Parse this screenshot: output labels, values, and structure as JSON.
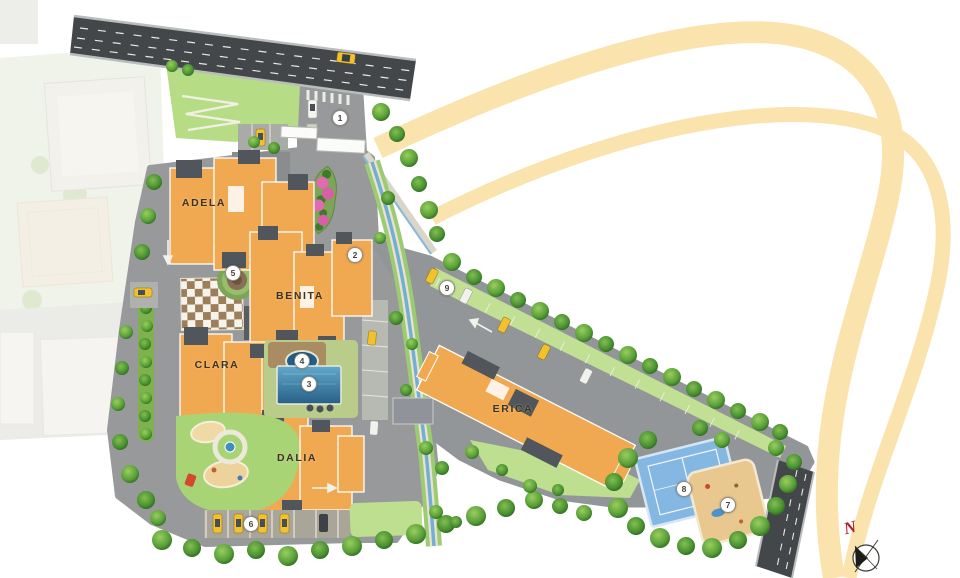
{
  "plan": {
    "type": "residential-site-plan",
    "buildings": [
      {
        "id": "adela",
        "label": "ADELA",
        "x": 204,
        "y": 203
      },
      {
        "id": "benita",
        "label": "BENITA",
        "x": 300,
        "y": 296
      },
      {
        "id": "clara",
        "label": "CLARA",
        "x": 217,
        "y": 365
      },
      {
        "id": "dalia",
        "label": "DALIA",
        "x": 297,
        "y": 458
      },
      {
        "id": "erica",
        "label": "ERICA",
        "x": 513,
        "y": 409
      }
    ],
    "markers": [
      {
        "number": "1",
        "x": 340,
        "y": 118
      },
      {
        "number": "2",
        "x": 355,
        "y": 255
      },
      {
        "number": "3",
        "x": 309,
        "y": 384
      },
      {
        "number": "4",
        "x": 302,
        "y": 361
      },
      {
        "number": "5",
        "x": 233,
        "y": 273
      },
      {
        "number": "6",
        "x": 251,
        "y": 524
      },
      {
        "number": "7",
        "x": 728,
        "y": 505
      },
      {
        "number": "8",
        "x": 684,
        "y": 489
      },
      {
        "number": "9",
        "x": 447,
        "y": 288
      }
    ],
    "compass": {
      "north_label": "N"
    },
    "palette": {
      "building_orange": "#F1A951",
      "roof_slate": "#50565C",
      "arc_wheat": "#FAE3AC",
      "pool_blue": "#2F7EA8",
      "tennis_blue": "#85B7E3",
      "sand_tan": "#E9C88F",
      "road_dark": "#43474A",
      "pavement_gray": "#97999B",
      "lawn_green": "#A9D476",
      "tree_green": "#3E7A26",
      "taxi_yellow": "#F2C12E",
      "flower_pink": "#E06BB0",
      "compass_red": "#B51F23",
      "marker_bg": "#FFFFFF"
    }
  }
}
